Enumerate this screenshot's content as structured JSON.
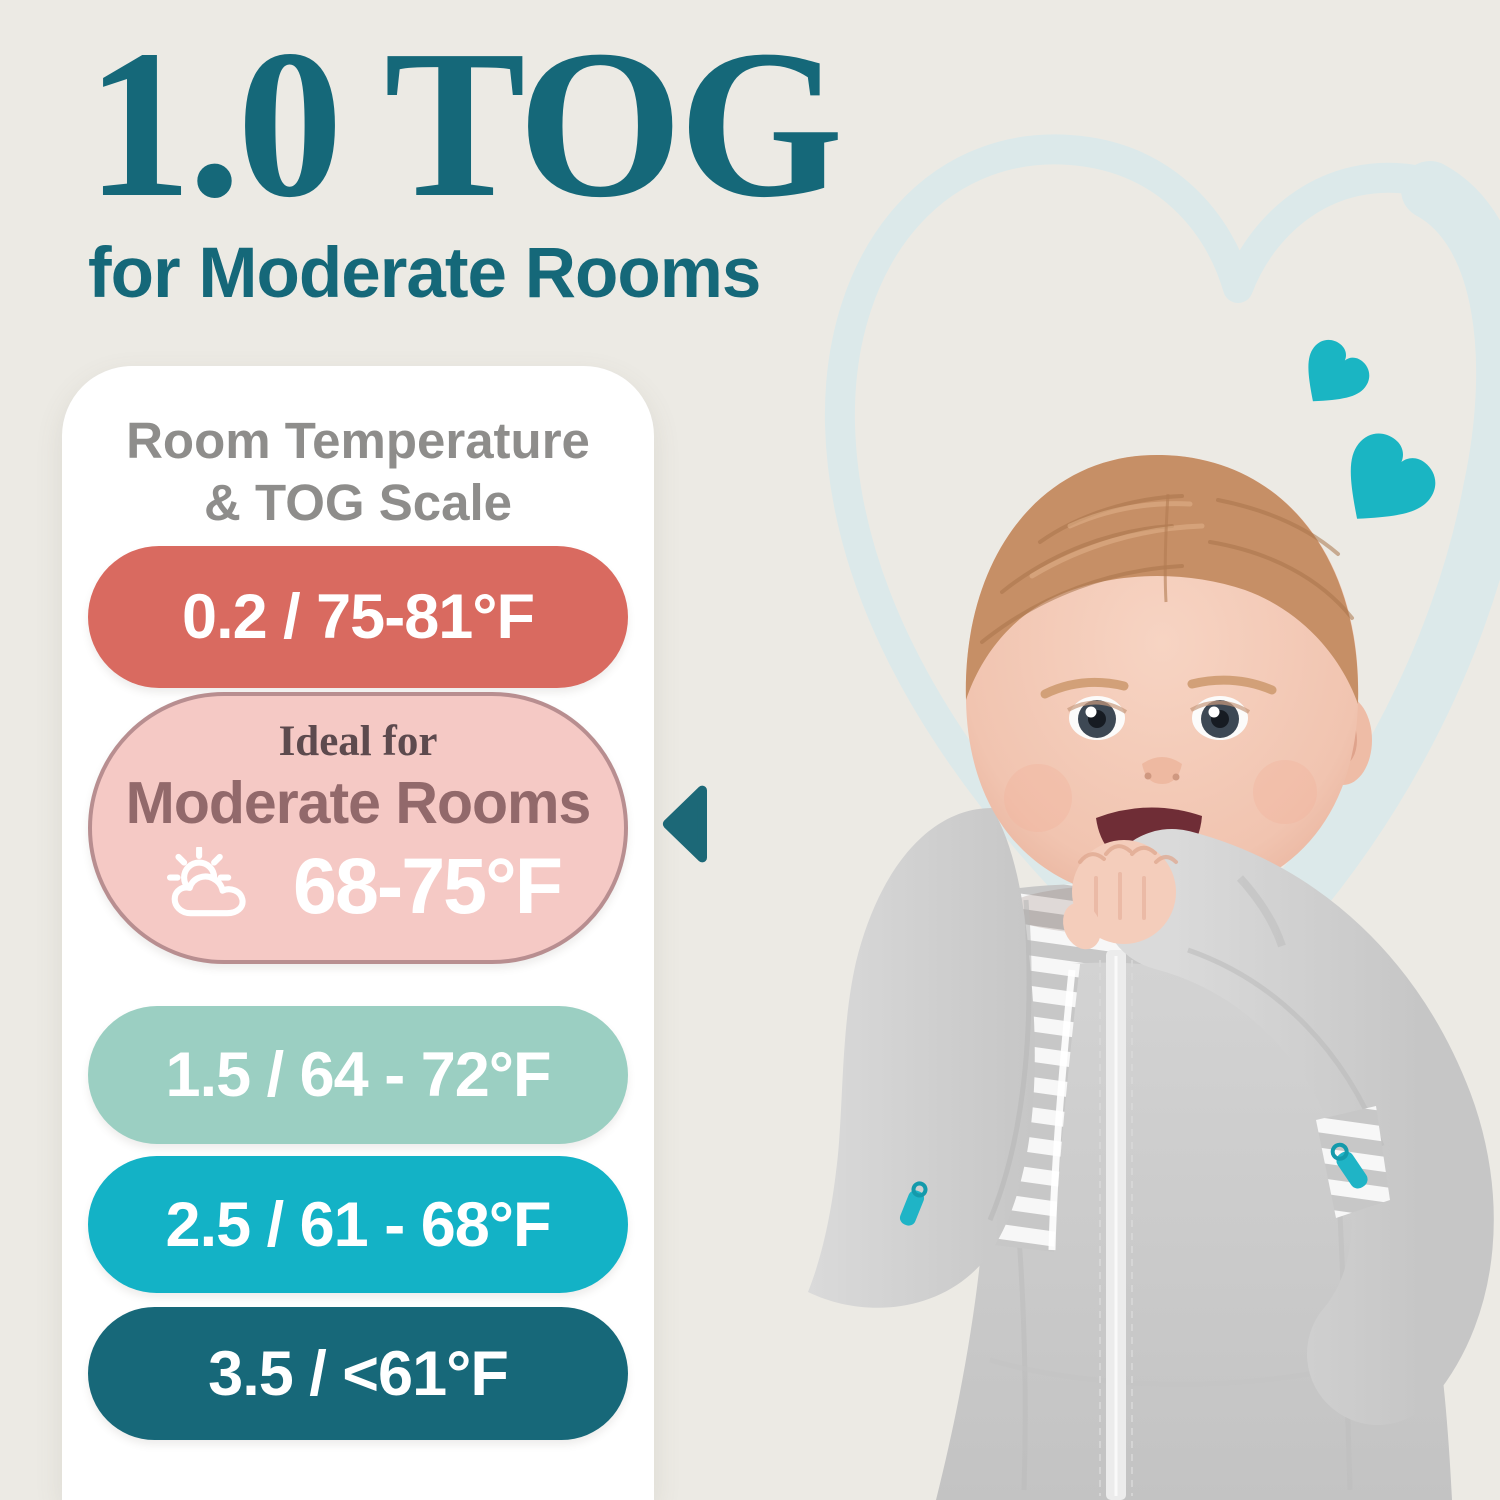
{
  "header": {
    "title": "1.0 TOG",
    "subtitle": "for Moderate Rooms"
  },
  "scale_card": {
    "heading_line1": "Room Temperature",
    "heading_line2": "& TOG Scale",
    "rows": [
      {
        "label": "0.2 / 75-81°F",
        "bg": "#d96a60"
      },
      {
        "ideal_label": "Ideal for",
        "room_label": "Moderate Rooms",
        "temp_label": "68-75°F",
        "bg": "#f5c9c5",
        "border": "#b88e90",
        "icon": "sun-behind-cloud"
      },
      {
        "label": "1.5 / 64 - 72°F",
        "bg": "#9bcfc2"
      },
      {
        "label": "2.5 / 61 - 68°F",
        "bg": "#13b2c6"
      },
      {
        "label": "3.5 / <61°F",
        "bg": "#176879"
      }
    ]
  },
  "colors": {
    "background": "#eceae4",
    "title_text": "#156879",
    "heading_text": "#8e8d8b",
    "pill_text": "#ffffff",
    "ideal_text": "#5d4a4e",
    "room_text": "#92696b",
    "arrow": "#1c6877",
    "heart_outline": "#dce9ea",
    "heart_solid": "#1ab5c3",
    "zipper_pull": "#1fb4c6"
  },
  "illustration": {
    "alt": "Smiling baby chewing its fist, wearing a gray arms-up swaddle sleep sack with center zipper"
  }
}
